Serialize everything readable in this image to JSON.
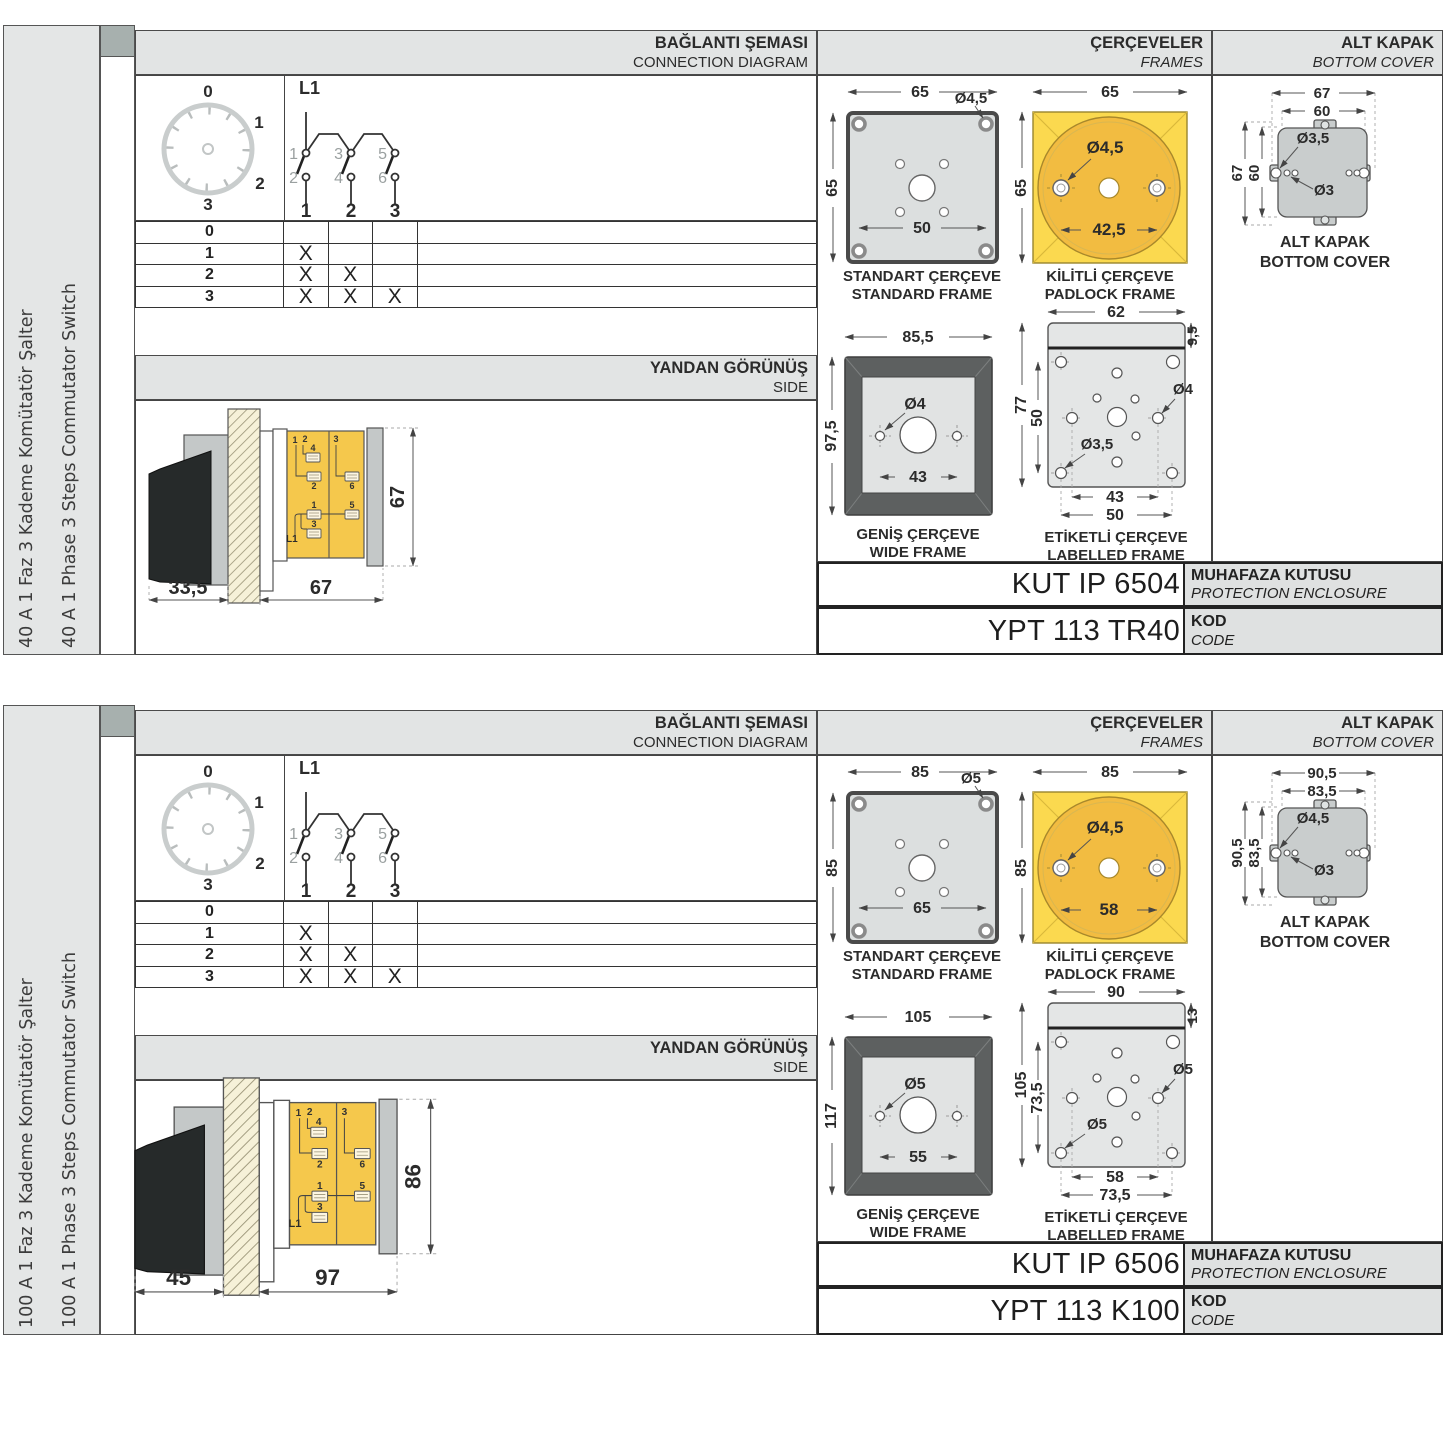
{
  "colors": {
    "body-yellow": "#f5c84c",
    "padlock-square": "#fbd94f",
    "padlock-circle": "#f2bc41",
    "band-gray": "#e2e4e4",
    "frame-dark": "#5d6060",
    "cover-gray": "#c9cdcd"
  },
  "panels": [
    {
      "sidebar": {
        "line1": "40 A 1 Faz 3 Kademe Komütatör Şalter",
        "line2": "40 A 1 Phase 3 Steps Commutator Switch"
      },
      "headers": {
        "conn_tr": "BAĞLANTI ŞEMASI",
        "conn_en": "CONNECTION DIAGRAM",
        "frames_tr": "ÇERÇEVELER",
        "frames_en": "FRAMES",
        "cover_tr": "ALT KAPAK",
        "cover_en": "BOTTOM COVER",
        "side_tr": "YANDAN GÖRÜNÜŞ",
        "side_en": "SIDE"
      },
      "dial": {
        "d0": "0",
        "d1": "1",
        "d2": "2",
        "d3": "3"
      },
      "circuit": {
        "l1": "L1",
        "t1": "1",
        "t2": "2",
        "t3": "3",
        "t4": "4",
        "t5": "5",
        "t6": "6",
        "p1": "1",
        "p2": "2",
        "p3": "3"
      },
      "table": {
        "rows": [
          [
            "0",
            "",
            "",
            ""
          ],
          [
            "1",
            "X",
            "",
            ""
          ],
          [
            "2",
            "X",
            "X",
            ""
          ],
          [
            "3",
            "X",
            "X",
            "X"
          ]
        ]
      },
      "side": {
        "front": "33,5",
        "body": "67",
        "height": "67",
        "n1": "1",
        "n2": "2",
        "n4": "4",
        "n2b": "2",
        "n3": "3",
        "n6": "6",
        "n1b": "1",
        "n5": "5",
        "n3b": "3",
        "l1": "L1"
      },
      "frames": {
        "standard": {
          "w": "65",
          "h": "65",
          "hole": "Ø4,5",
          "pitch": "50",
          "cap_tr": "STANDART ÇERÇEVE",
          "cap_en": "STANDARD FRAME"
        },
        "padlock": {
          "w": "65",
          "h": "65",
          "hole": "Ø4,5",
          "pitch": "42,5",
          "cap_tr": "KİLİTLİ ÇERÇEVE",
          "cap_en": "PADLOCK FRAME"
        },
        "wide": {
          "w": "85,5",
          "h": "97,5",
          "hole": "Ø4",
          "pitch": "43",
          "cap_tr": "GENİŞ ÇERÇEVE",
          "cap_en": "WIDE FRAME"
        },
        "labelled": {
          "w": "62",
          "strip": "9,5",
          "h": "77",
          "pitch_v": "50",
          "hole_big": "Ø4",
          "hole_small": "Ø3,5",
          "pitch_h1": "43",
          "pitch_h2": "50",
          "cap_tr": "ETİKETLİ ÇERÇEVE",
          "cap_en": "LABELLED FRAME"
        }
      },
      "cover": {
        "w1": "67",
        "w2": "60",
        "h1": "67",
        "h2": "60",
        "hole_big": "Ø3,5",
        "hole_small": "Ø3",
        "cap_tr": "ALT KAPAK",
        "cap_en": "BOTTOM COVER"
      },
      "codes": {
        "enclosure": "KUT IP 6504",
        "enclosure_tr": "MUHAFAZA KUTUSU",
        "enclosure_en": "PROTECTION ENCLOSURE",
        "code": "YPT 113 TR40",
        "code_tr": "KOD",
        "code_en": "CODE"
      }
    },
    {
      "sidebar": {
        "line1": "100 A 1 Faz 3 Kademe Komütatör Şalter",
        "line2": "100 A 1 Phase 3 Steps Commutator Switch"
      },
      "headers": {
        "conn_tr": "BAĞLANTI ŞEMASI",
        "conn_en": "CONNECTION DIAGRAM",
        "frames_tr": "ÇERÇEVELER",
        "frames_en": "FRAMES",
        "cover_tr": "ALT KAPAK",
        "cover_en": "BOTTOM COVER",
        "side_tr": "YANDAN GÖRÜNÜŞ",
        "side_en": "SIDE"
      },
      "dial": {
        "d0": "0",
        "d1": "1",
        "d2": "2",
        "d3": "3"
      },
      "circuit": {
        "l1": "L1",
        "t1": "1",
        "t2": "2",
        "t3": "3",
        "t4": "4",
        "t5": "5",
        "t6": "6",
        "p1": "1",
        "p2": "2",
        "p3": "3"
      },
      "table": {
        "rows": [
          [
            "0",
            "",
            "",
            ""
          ],
          [
            "1",
            "X",
            "",
            ""
          ],
          [
            "2",
            "X",
            "X",
            ""
          ],
          [
            "3",
            "X",
            "X",
            "X"
          ]
        ]
      },
      "side": {
        "front": "45",
        "body": "97",
        "height": "86",
        "n1": "1",
        "n2": "2",
        "n4": "4",
        "n2b": "2",
        "n3": "3",
        "n6": "6",
        "n1b": "1",
        "n5": "5",
        "n3b": "3",
        "l1": "L1"
      },
      "frames": {
        "standard": {
          "w": "85",
          "h": "85",
          "hole": "Ø5",
          "pitch": "65",
          "cap_tr": "STANDART ÇERÇEVE",
          "cap_en": "STANDARD FRAME"
        },
        "padlock": {
          "w": "85",
          "h": "85",
          "hole": "Ø4,5",
          "pitch": "58",
          "cap_tr": "KİLİTLİ ÇERÇEVE",
          "cap_en": "PADLOCK FRAME"
        },
        "wide": {
          "w": "105",
          "h": "117",
          "hole": "Ø5",
          "pitch": "55",
          "cap_tr": "GENİŞ ÇERÇEVE",
          "cap_en": "WIDE FRAME"
        },
        "labelled": {
          "w": "90",
          "strip": "13",
          "h": "105",
          "pitch_v": "73,5",
          "hole_big": "Ø5",
          "hole_small": "Ø5",
          "pitch_h1": "58",
          "pitch_h2": "73,5",
          "cap_tr": "ETİKETLİ ÇERÇEVE",
          "cap_en": "LABELLED FRAME"
        }
      },
      "cover": {
        "w1": "90,5",
        "w2": "83,5",
        "h1": "90,5",
        "h2": "83,5",
        "hole_big": "Ø4,5",
        "hole_small": "Ø3",
        "cap_tr": "ALT KAPAK",
        "cap_en": "BOTTOM COVER"
      },
      "codes": {
        "enclosure": "KUT IP 6506",
        "enclosure_tr": "MUHAFAZA KUTUSU",
        "enclosure_en": "PROTECTION ENCLOSURE",
        "code": "YPT 113 K100",
        "code_tr": "KOD",
        "code_en": "CODE"
      }
    }
  ]
}
